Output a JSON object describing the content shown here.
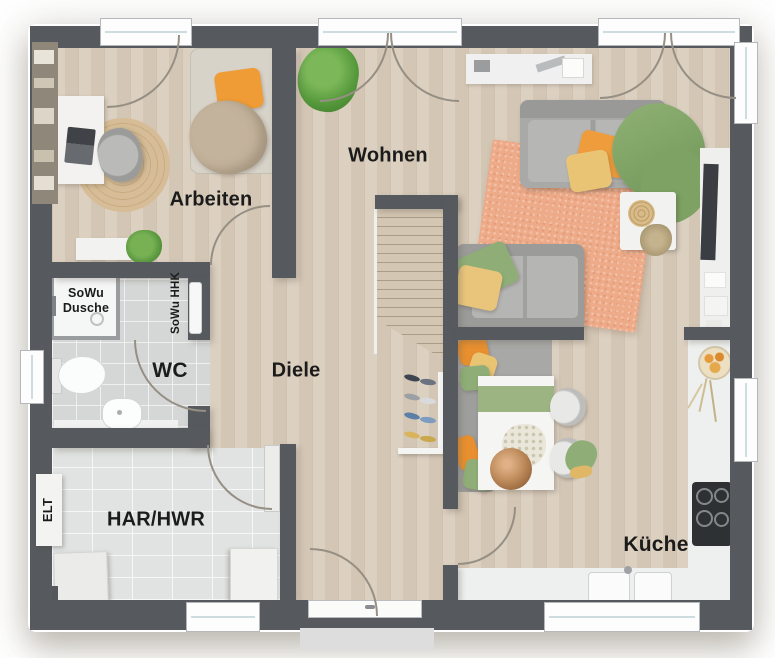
{
  "plan": {
    "type": "floor-plan",
    "style": "top-down 3D render"
  },
  "rooms": {
    "arbeiten": {
      "label": "Arbeiten"
    },
    "wohnen": {
      "label": "Wohnen"
    },
    "diele": {
      "label": "Diele"
    },
    "wc": {
      "label": "WC"
    },
    "har_hwr": {
      "label": "HAR/HWR"
    },
    "kueche": {
      "label": "Küche"
    }
  },
  "annotations": {
    "shower_line1": "SoWu",
    "shower_line2": "Dusche",
    "towel_radiator": "SoWu HHK",
    "electrical": "ELT"
  },
  "colors": {
    "wall": "#565a5e",
    "wood_floor": "#d8cbba",
    "tile_floor": "#d5d7d7",
    "counter_white": "#eef0ef",
    "rug_orange": "#eeab89",
    "sofa_gray": "#a9a9a7",
    "accent_green": "#8fae77",
    "accent_orange": "#ef9d3c",
    "accent_yellow": "#e8c475"
  }
}
